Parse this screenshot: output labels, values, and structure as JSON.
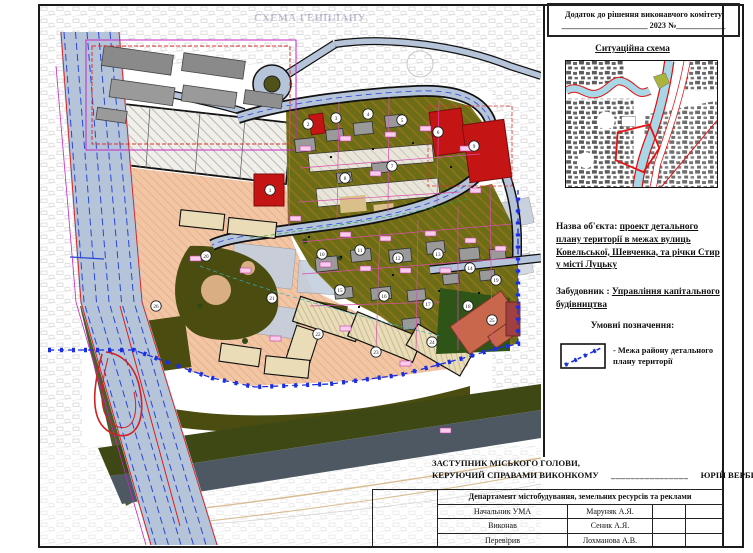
{
  "document": {
    "stamp": {
      "line1": "Додаток до рішення виконавчого комітету",
      "line2": "_____________________ 2023 №____________"
    },
    "plan_title": "СХЕМА ГЕНПЛАНУ",
    "situational_title": "Ситуаційна схема",
    "object_label": "Назва об'єкта:",
    "object_value": "проект детального плану території в межах вулиць Ковельської, Шевченка, та річки Стир у місті Луцьку",
    "developer_label": "Забудовник :",
    "developer_value": "Управління капітального будівництва",
    "legend_title": "Умовні позначення:",
    "legend_items": [
      {
        "symbol": "blue-dashed-boundary",
        "label": "- Межа району детального плану території"
      }
    ],
    "signature": {
      "line1": "ЗАСТУПНИК МІСЬКОГО ГОЛОВИ,",
      "line2": "КЕРУЮЧИЙ СПРАВАМИ ВИКОНКОМУ",
      "blank": "________________",
      "name": "ЮРІЙ ВЕРБИЧ"
    },
    "approval_table": {
      "header": "Департамент містобудування, земельних ресурсів та реклами",
      "rows": [
        {
          "role": "Начальник УМА",
          "name": "Маруняк А.Я."
        },
        {
          "role": "Виконав",
          "name": "Сеник А.Я."
        },
        {
          "role": "Перевірив",
          "name": "Лохманова А.В."
        }
      ]
    },
    "map": {
      "boundary_color": "#1c2fe0",
      "road_color": "#b6c4da",
      "zone_colors": {
        "residential_existing": "#f2c6a5",
        "mixed_green": "#6d6d17",
        "park": "#4a4c10",
        "river": "#4d5862",
        "planned_building": "#e9dcb6",
        "red_building": "#c41414",
        "school_building": "#c8674c"
      },
      "markers": [
        {
          "x": 230,
          "y": 184,
          "n": "1"
        },
        {
          "x": 268,
          "y": 118,
          "n": "2"
        },
        {
          "x": 296,
          "y": 112,
          "n": "3"
        },
        {
          "x": 328,
          "y": 108,
          "n": "4"
        },
        {
          "x": 362,
          "y": 114,
          "n": "5"
        },
        {
          "x": 398,
          "y": 126,
          "n": "6"
        },
        {
          "x": 352,
          "y": 160,
          "n": "7"
        },
        {
          "x": 305,
          "y": 172,
          "n": "8"
        },
        {
          "x": 434,
          "y": 140,
          "n": "9"
        },
        {
          "x": 282,
          "y": 248,
          "n": "10"
        },
        {
          "x": 320,
          "y": 244,
          "n": "11"
        },
        {
          "x": 358,
          "y": 252,
          "n": "12"
        },
        {
          "x": 398,
          "y": 248,
          "n": "13"
        },
        {
          "x": 430,
          "y": 262,
          "n": "14"
        },
        {
          "x": 300,
          "y": 284,
          "n": "15"
        },
        {
          "x": 344,
          "y": 290,
          "n": "16"
        },
        {
          "x": 388,
          "y": 298,
          "n": "17"
        },
        {
          "x": 428,
          "y": 300,
          "n": "18"
        },
        {
          "x": 456,
          "y": 274,
          "n": "19"
        },
        {
          "x": 166,
          "y": 250,
          "n": "20"
        },
        {
          "x": 232,
          "y": 292,
          "n": "21"
        },
        {
          "x": 278,
          "y": 328,
          "n": "22"
        },
        {
          "x": 336,
          "y": 346,
          "n": "23"
        },
        {
          "x": 392,
          "y": 336,
          "n": "24"
        },
        {
          "x": 452,
          "y": 314,
          "n": "25"
        },
        {
          "x": 116,
          "y": 300,
          "n": "26"
        }
      ]
    }
  }
}
